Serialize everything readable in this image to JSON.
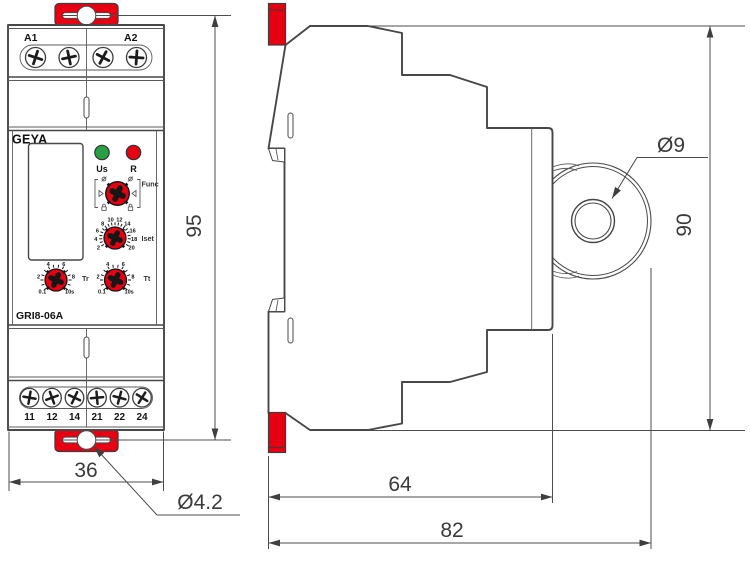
{
  "colors": {
    "red": "#e60012",
    "green": "#27a045",
    "line": "#4c4c4c",
    "ink": "#1f1f1f"
  },
  "front": {
    "brand": "GEYA",
    "model": "GRI8-06A",
    "terminals_top": [
      "A1",
      "A2"
    ],
    "terminals_bottom": [
      "11",
      "12",
      "14",
      "21",
      "22",
      "24"
    ],
    "led_us_label": "Us",
    "led_r_label": "R",
    "dials": {
      "func": {
        "label": "Func",
        "icons": [
          "screwdriver-icon",
          "screwdriver-icon",
          "padlock-icon",
          "padlock-icon",
          "triangle-left-icon",
          "triangle-right-icon"
        ]
      },
      "iset": {
        "label": "Iset",
        "scale": [
          "2",
          "4",
          "6",
          "8",
          "10",
          "12",
          "14",
          "16",
          "18",
          "20"
        ]
      },
      "tr": {
        "label": "Tr",
        "scale": [
          "0.1",
          "2",
          "4",
          "6",
          "8",
          "10s"
        ]
      },
      "tt": {
        "label": "Tt",
        "scale": [
          "0.1",
          "2",
          "4",
          "6",
          "8",
          "10s"
        ]
      }
    }
  },
  "dimensions": {
    "front_height": "95",
    "front_width": "36",
    "tab_hole_diameter": "Ø4.2",
    "ear_hole_diameter": "Ø9",
    "side_height": "90",
    "body_depth": "64",
    "total_depth": "82"
  }
}
